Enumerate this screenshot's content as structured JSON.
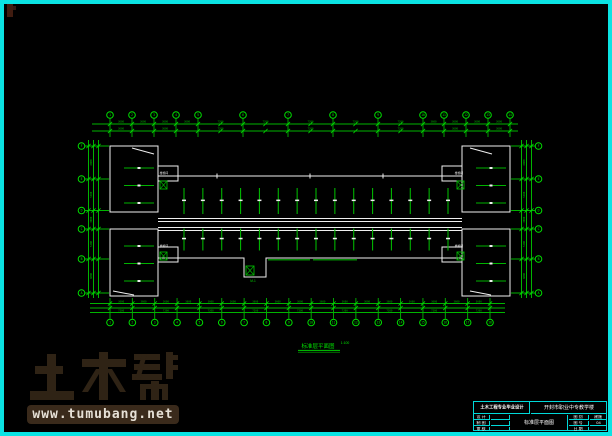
{
  "canvas": {
    "background": "#000000",
    "border_color": "#0be3e3",
    "line_green": "#00b400",
    "line_bright_green": "#00e000",
    "outline_white": "#f0f0f0",
    "titleblock_cyan": "#00d9d9"
  },
  "drawing": {
    "plan_label": "标准层平面图",
    "plan_scale": "1:100",
    "stair_label": "楼梯间",
    "entrance_label": "M-1",
    "grid": {
      "top_labels": [
        "1",
        "2",
        "3",
        "4",
        "5",
        "6",
        "7",
        "8",
        "9",
        "10",
        "11",
        "12",
        "13",
        "14"
      ],
      "bottom_labels": [
        "1",
        "2",
        "3",
        "4",
        "5",
        "6",
        "7",
        "8",
        "9",
        "10",
        "11",
        "12",
        "13",
        "14",
        "15",
        "16",
        "17",
        "18"
      ],
      "side_labels": [
        "F",
        "E",
        "D",
        "C",
        "B",
        "A"
      ]
    },
    "dims": {
      "bay": "3600",
      "double_bay": "7200",
      "side": [
        "6000",
        "5400",
        "3000",
        "5400",
        "6000"
      ],
      "total_width": "75600"
    }
  },
  "title_block": {
    "project_org": "土木工程专业毕业设计",
    "project_name": "开封市职业中专教学楼",
    "drawing_name": "标准层平面图",
    "rows": [
      {
        "label": "设 计",
        "value": ""
      },
      {
        "label": "制 图",
        "value": ""
      },
      {
        "label": "审 核",
        "value": ""
      }
    ],
    "meta": [
      {
        "label": "图 别",
        "value": "建施"
      },
      {
        "label": "图 号",
        "value": "04"
      },
      {
        "label": "日 期",
        "value": ""
      }
    ]
  },
  "watermark": {
    "logo": "土木帮",
    "url": "www.tumubang.net"
  }
}
